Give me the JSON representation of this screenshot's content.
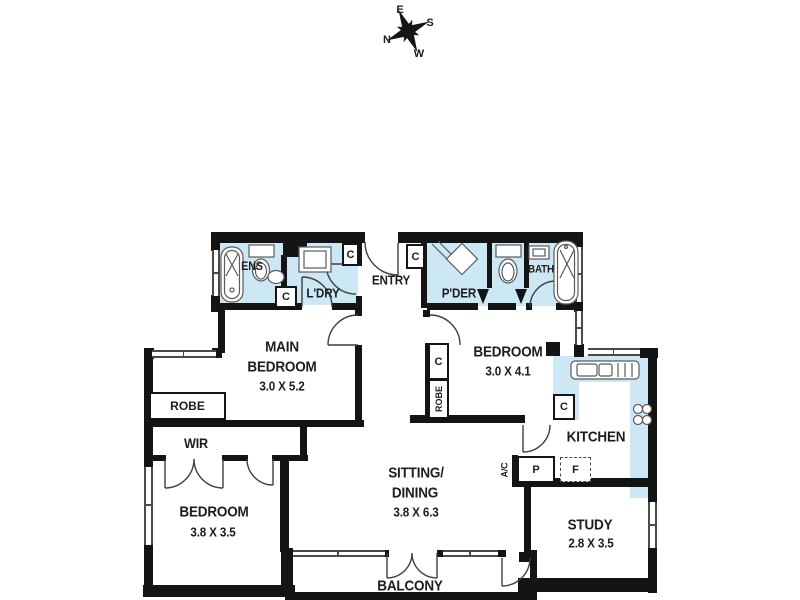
{
  "compass": {
    "e": "E",
    "s": "S",
    "w": "W",
    "n": "N"
  },
  "rooms": {
    "ens": {
      "name": "ENS"
    },
    "laundry": {
      "name": "L'DRY"
    },
    "entry": {
      "name": "ENTRY"
    },
    "powder": {
      "name": "P'DER"
    },
    "bath": {
      "name": "BATH"
    },
    "main_bedroom": {
      "name_line1": "MAIN",
      "name_line2": "BEDROOM",
      "dims": "3.0 X 5.2"
    },
    "bedroom2": {
      "name": "BEDROOM",
      "dims": "3.0 X 4.1"
    },
    "bedroom3": {
      "name": "BEDROOM",
      "dims": "3.8 X 3.5"
    },
    "sitting_dining": {
      "name_line1": "SITTING/",
      "name_line2": "DINING",
      "dims": "3.8 X 6.3"
    },
    "kitchen": {
      "name": "KITCHEN"
    },
    "study": {
      "name": "STUDY",
      "dims": "2.8 X 3.5"
    },
    "balcony": {
      "name": "BALCONY"
    },
    "wir": {
      "name": "WIR"
    }
  },
  "storage": {
    "cupboard": "C",
    "robe": "ROBE",
    "pantry": "P",
    "fridge": "F"
  },
  "equipment": {
    "ac": "A/C"
  },
  "legend_colors": {
    "wet_area_fill": "#cde8f5",
    "wall": "#141414",
    "background": "#ffffff"
  }
}
